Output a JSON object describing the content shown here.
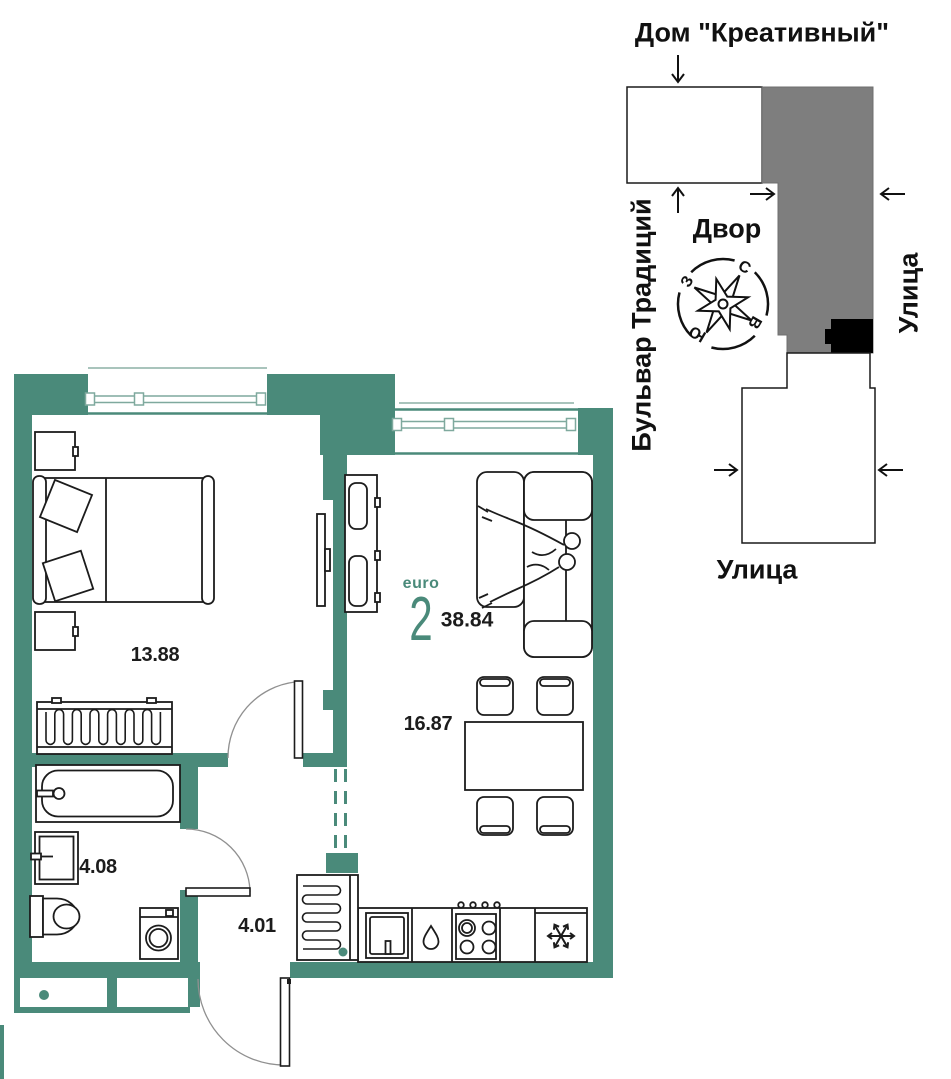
{
  "plan": {
    "type_label": "euro",
    "rooms_count": "2",
    "total_area": "38.84",
    "rooms": [
      {
        "name": "bedroom",
        "area": "13.88"
      },
      {
        "name": "kitchen-living-room",
        "area": "16.87"
      },
      {
        "name": "bathroom",
        "area": "4.08"
      },
      {
        "name": "hallway",
        "area": "4.01"
      }
    ]
  },
  "minimap": {
    "building_label": "Дом \"Креативный\"",
    "yard_label": "Двор",
    "street_left_label": "Бульвар Традиций",
    "street_right_label": "Улица",
    "street_bottom_label": "Улица",
    "compass": {
      "north": "С",
      "east": "В",
      "south": "Ю",
      "west": "З"
    }
  },
  "colors": {
    "wall_teal": "#4a8a7a",
    "accent_teal": "#4a8a7a",
    "building_gray": "#7e7e7e",
    "marker_black": "#000000",
    "line_dark": "#1c1c1c"
  }
}
